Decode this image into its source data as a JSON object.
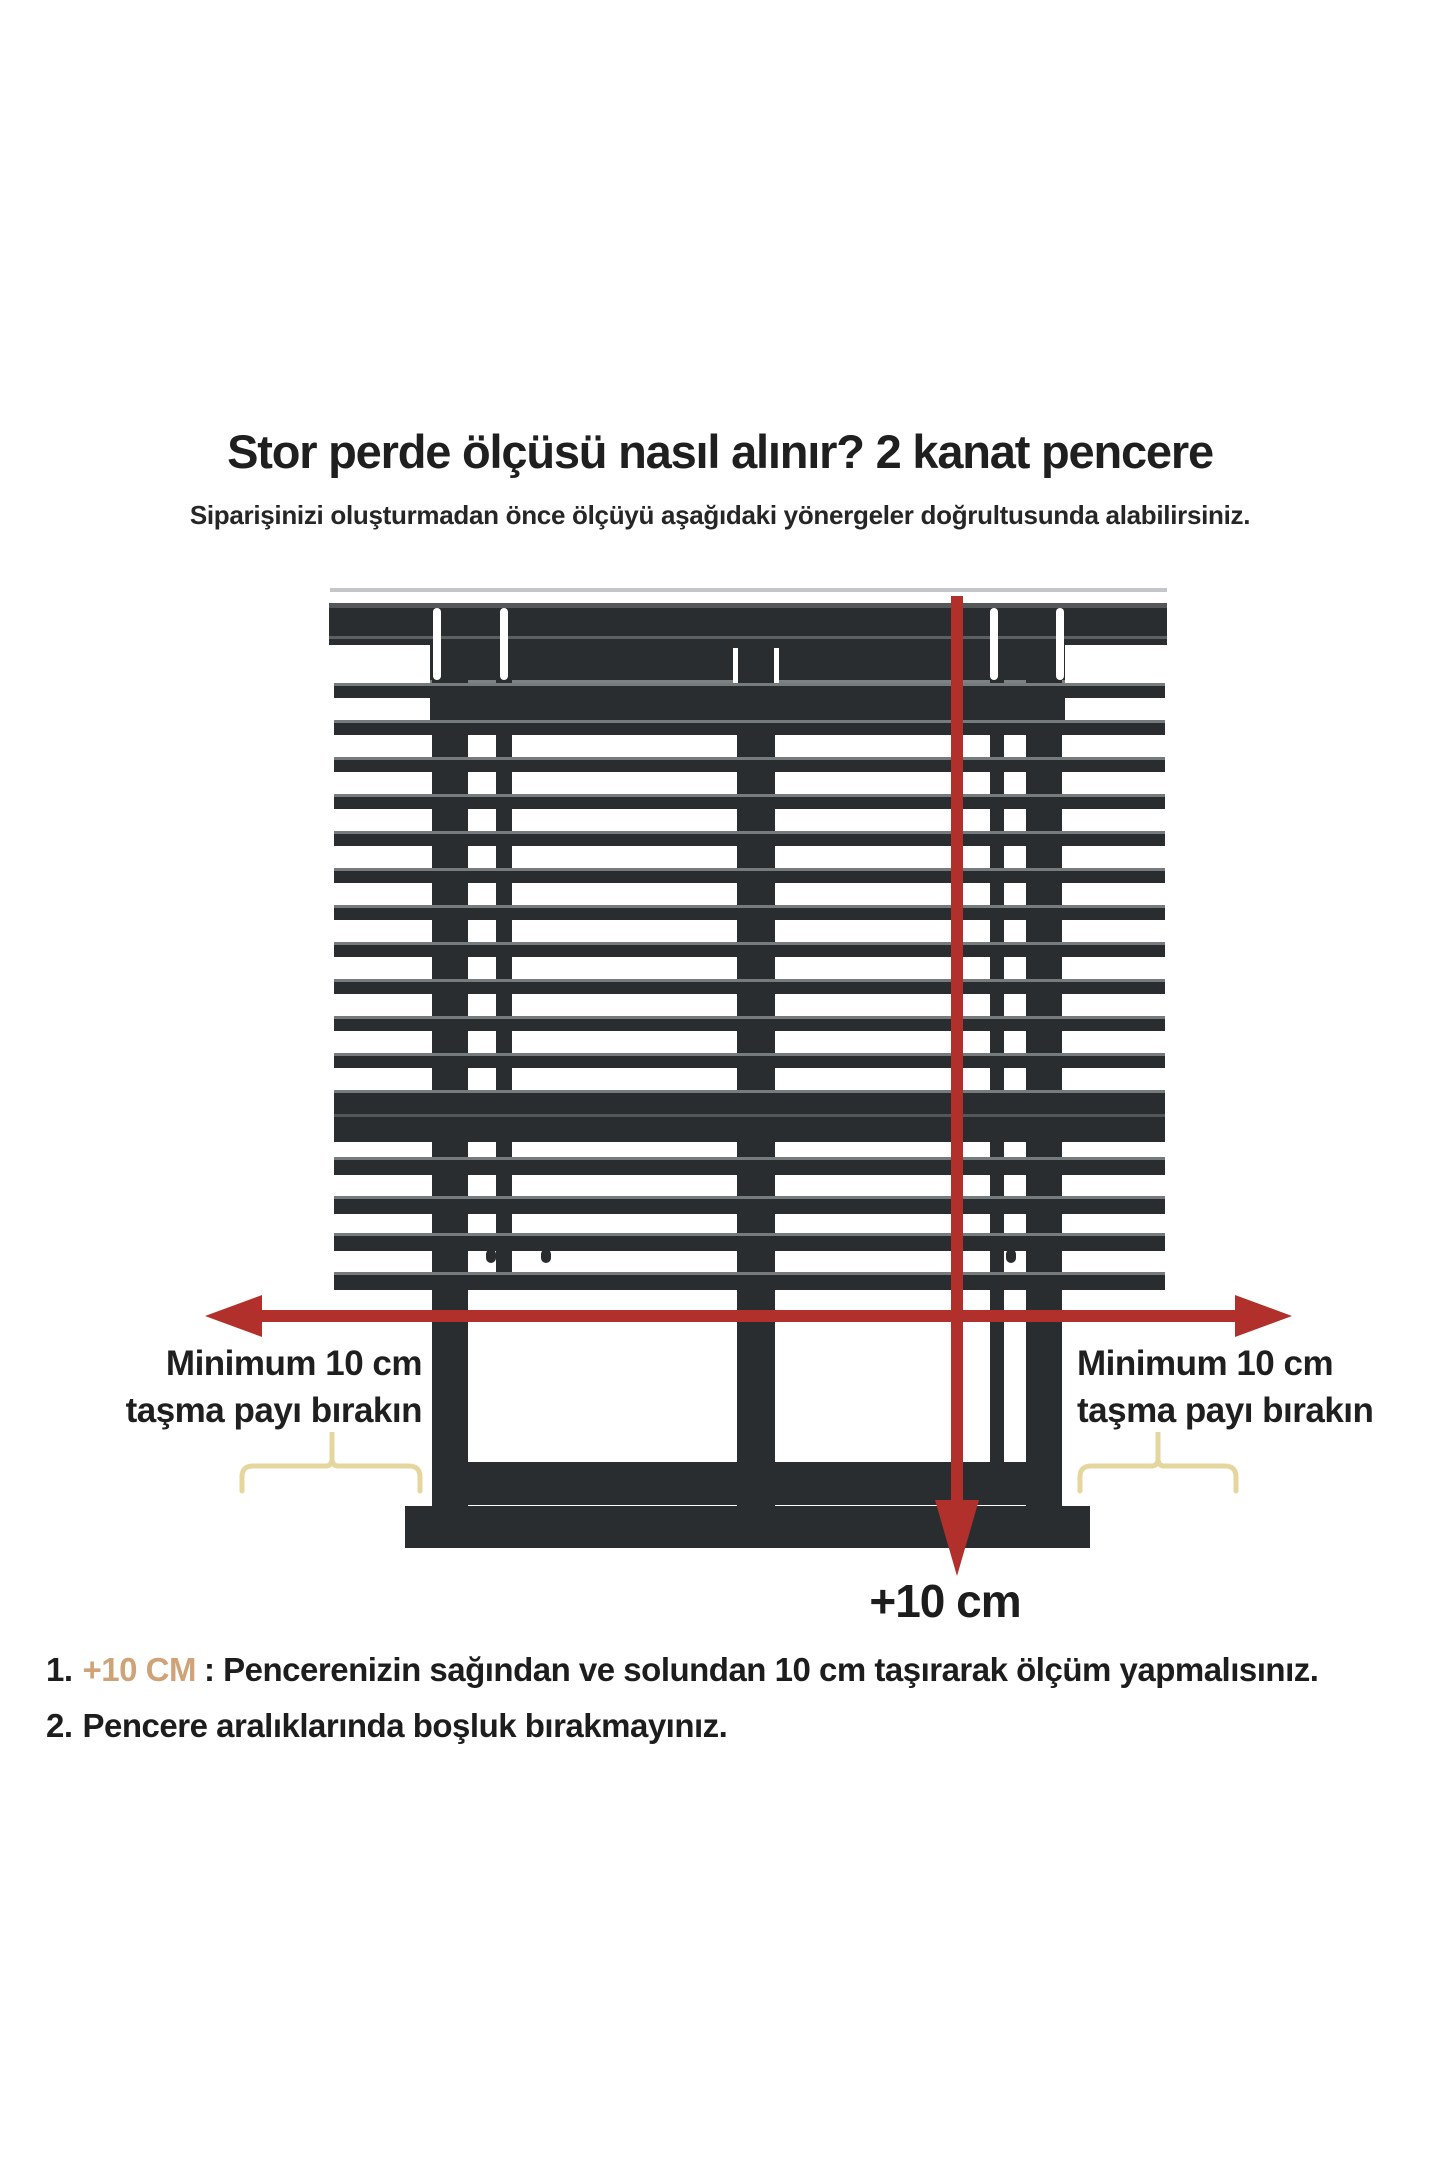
{
  "header": {
    "title": "Stor perde ölçüsü nasıl alınır? 2 kanat pencere",
    "subtitle": "Siparişinizi oluşturmadan önce ölçüyü aşağıdaki yönergeler doğrultusunda alabilirsiniz."
  },
  "diagram": {
    "left_label": {
      "line1": "Minimum 10 cm",
      "line2": "taşma payı bırakın"
    },
    "right_label": {
      "line1": "Minimum 10 cm",
      "line2": "taşma payı bırakın"
    },
    "bottom_arrow_label": "+10 cm"
  },
  "instructions": {
    "item1": {
      "number": "1.",
      "highlight": "+10 CM",
      "text": ": Pencerenizin sağından ve solundan 10 cm taşırarak ölçüm yapmalısınız."
    },
    "item2": {
      "number": "2.",
      "text": "Pencere aralıklarında boşluk bırakmayınız."
    }
  },
  "colors": {
    "dark": "#2a2d2f",
    "hl": "#767b7e",
    "seam": "#7d8285",
    "red": "#b1302c",
    "yellow": "#e5d69d",
    "tan": "#cfa377",
    "ink": "#1f1f1f",
    "faint": "#c3c6c8"
  }
}
